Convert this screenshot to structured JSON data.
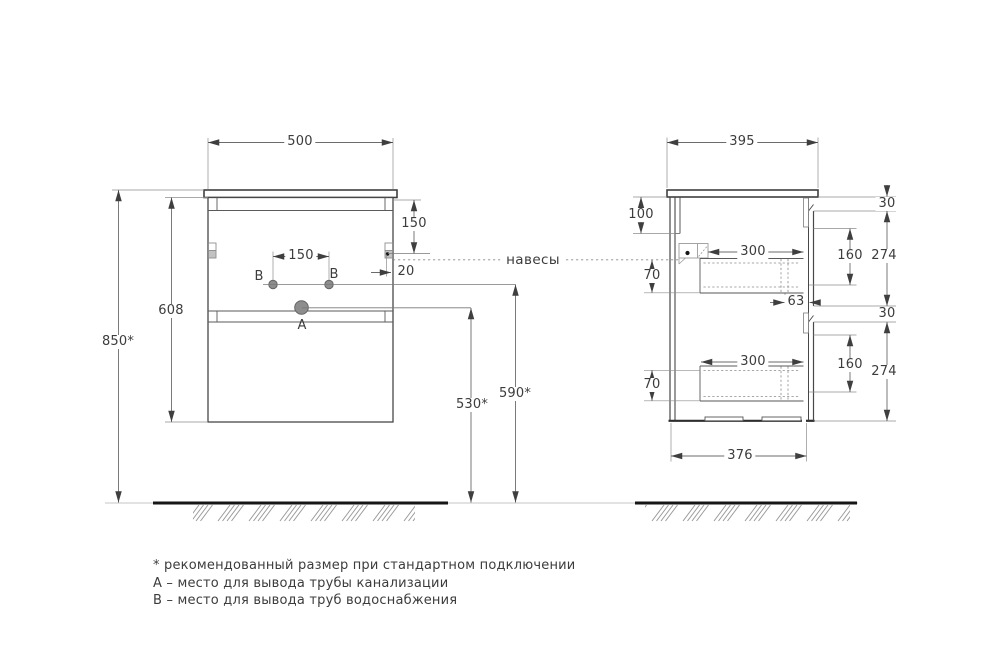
{
  "callout": "навесы",
  "points": {
    "drain": "A",
    "water": "B"
  },
  "dims": {
    "front": {
      "width": "500",
      "cabinet_height": "608",
      "height_above_floor": "850*",
      "hanger_from_top": "150",
      "hanger_from_side": "20",
      "water_outlets_spacing": "150",
      "water_outlet_height": "590*",
      "drain_outlet_height": "530*"
    },
    "side": {
      "depth": "395",
      "bottom_depth": "376",
      "back_panel_top": "100",
      "drawer_drop": "70",
      "drawer_depth": "300",
      "back_offset": "63",
      "front_gap": "30",
      "drawer_side_height": "160",
      "front_panel_height": "274"
    }
  },
  "notes": [
    "* рекомендованный размер при стандартном подключении",
    "А – место для вывода трубы канализации",
    "В – место для вывода труб водоснабжения"
  ]
}
